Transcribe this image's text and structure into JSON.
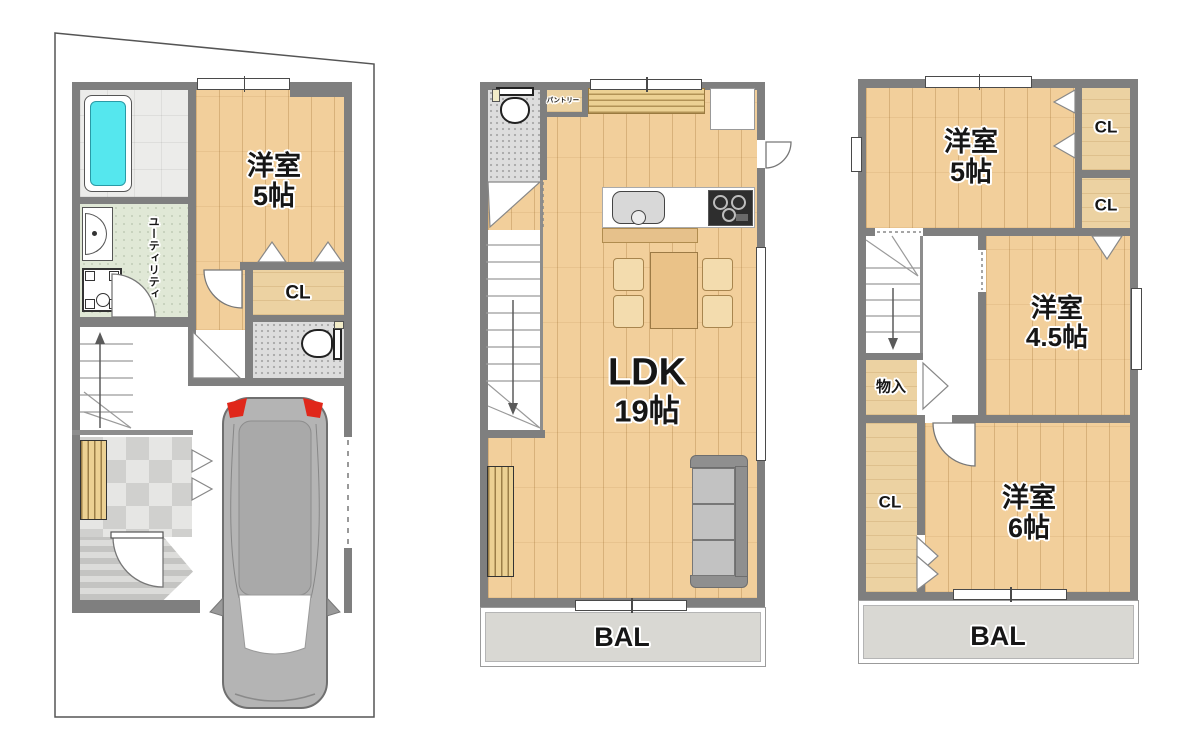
{
  "colors": {
    "wall": "#7f7f7f",
    "wood_floor": "#f2cf9b",
    "closet_floor": "#ecd2a2",
    "bathtub_cyan": "#55e7ee",
    "utility_green": "#e0e8d6",
    "balcony_gray": "#d9d8d3",
    "car_body": "#b4b4b4",
    "car_light_red": "#e0271a"
  },
  "floor1": {
    "room5": {
      "l1": "洋室",
      "l2": "5帖"
    },
    "cl": "CL",
    "utility": "ユーティリティ"
  },
  "floor2": {
    "pantry": "パントリー",
    "ldk": {
      "l1": "LDK",
      "l2": "19帖"
    },
    "bal": "BAL"
  },
  "floor3": {
    "room5": {
      "l1": "洋室",
      "l2": "5帖"
    },
    "cl1": "CL",
    "cl2": "CL",
    "room45": {
      "l1": "洋室",
      "l2": "4.5帖"
    },
    "storage": "物入",
    "cl3": "CL",
    "room6": {
      "l1": "洋室",
      "l2": "6帖"
    },
    "bal": "BAL"
  }
}
